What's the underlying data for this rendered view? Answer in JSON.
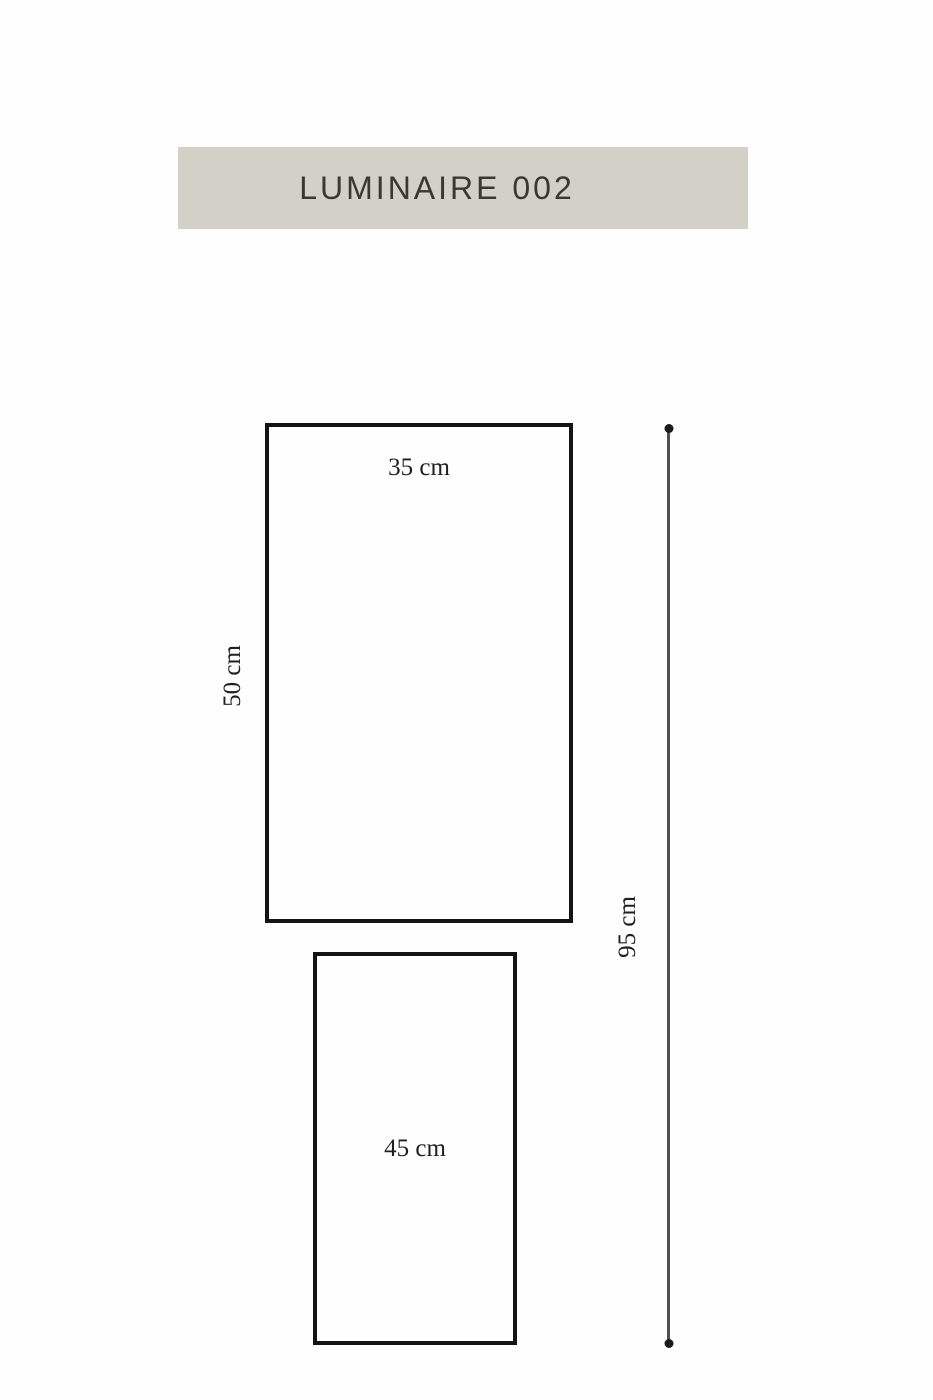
{
  "title": "LUMINAIRE 002",
  "diagram": {
    "top_rect": {
      "width_label": "35 cm",
      "height_label": "50 cm"
    },
    "bottom_rect": {
      "label": "45 cm"
    },
    "total_height": {
      "label": "95 cm"
    }
  },
  "icons": {
    "dimension_end_top": "dot",
    "dimension_end_bottom": "dot"
  },
  "colors": {
    "background": "#fefefe",
    "banner_bg": "#d3d0c7",
    "title_text": "#3a392f",
    "outline": "#141414",
    "dimension_line": "#4f4f4f",
    "label_text": "#1f1f1f"
  }
}
